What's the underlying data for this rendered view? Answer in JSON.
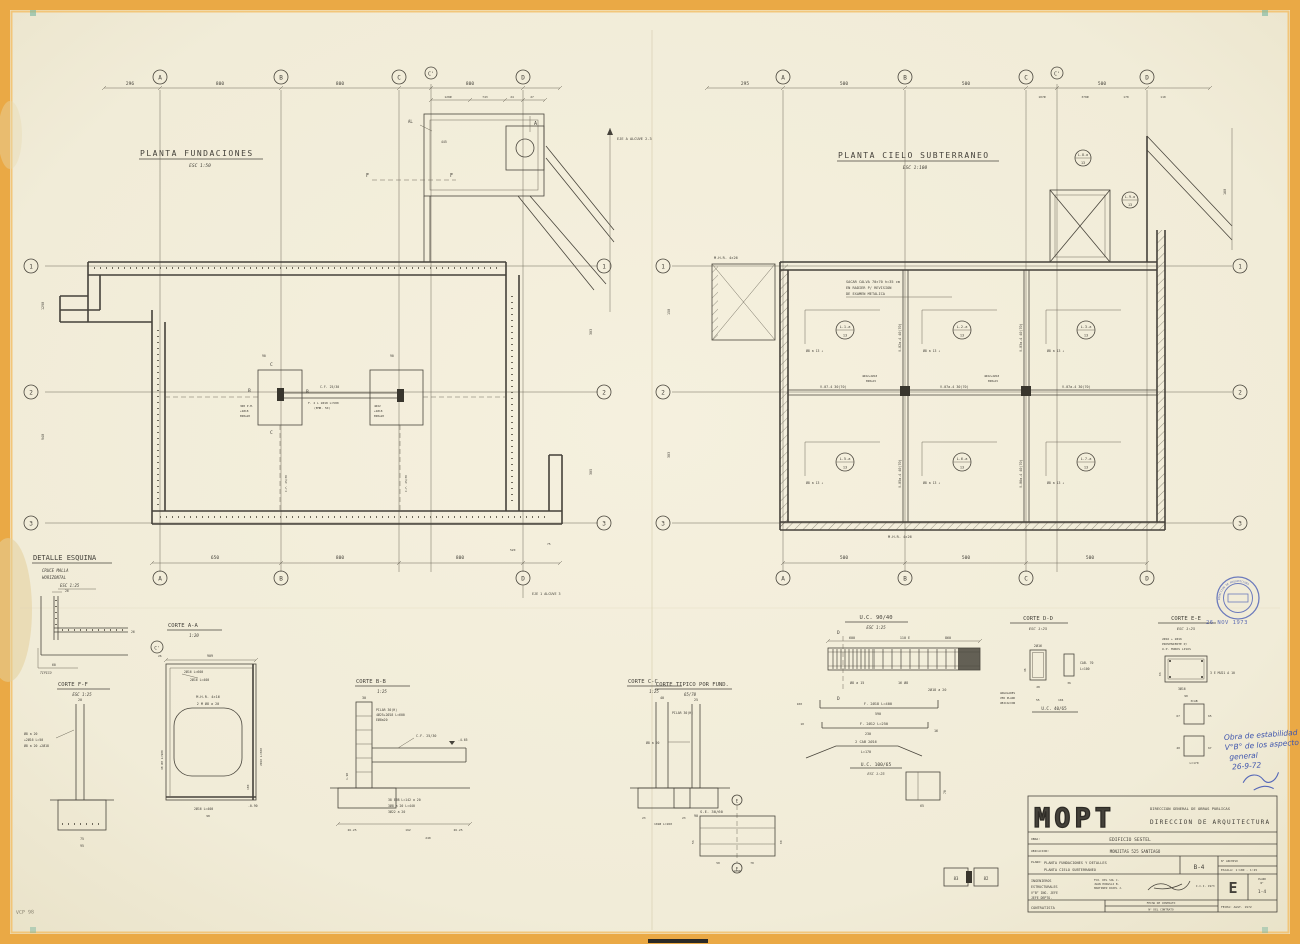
{
  "sheet": {
    "paper_color": "#f1ecd8",
    "border_color": "#e9a843",
    "ink_color": "#45423a",
    "stamp_blue": "#4456ac",
    "corner_code": "VCP 98"
  },
  "fp": {
    "title": "PLANTA FUNDACIONES",
    "scale": "ESC 1:50",
    "cols": [
      "A",
      "B",
      "C",
      "C'",
      "D"
    ],
    "rows": [
      "1",
      "2",
      "3"
    ],
    "top_dims": [
      "296",
      "800",
      "800",
      "800"
    ],
    "sub_dims": [
      "120Ø",
      "743",
      "24",
      "27"
    ],
    "bottom_dims": [
      "650",
      "800",
      "800"
    ],
    "left_dim_a": "1290",
    "left_dim_b": "940",
    "right_dim_a": "303",
    "right_dim_b": "305",
    "al": "AL",
    "a_mark": "A",
    "f_mark": "F",
    "dim_445": "445",
    "eje_top": "EJE A ALCUVE 2-3",
    "eje_bottom": "EJE 1 ALCUVE 3",
    "dim_520": "520",
    "dim_75": "75",
    "cf_tie": "C.F. 25/30",
    "tie_bar": "F. 2 L 2Ø18  L=580",
    "tie_emb": "(EMB. 50)",
    "b_mark": "B",
    "c_mark": "C",
    "dim_90": "90",
    "ped_left": [
      "3Ø8 P.M.",
      "+2Ø18",
      "EØ8a20"
    ],
    "ped_right": [
      "4Ø22",
      "+2Ø18",
      "EØ8a20"
    ],
    "cf_vert_left": "C.F. 25/30",
    "cf_vert_right": "C.F. 25/30"
  },
  "cp": {
    "title": "PLANTA CIELO SUBTERRANEO",
    "scale": "ESC 1:100",
    "cols": [
      "A",
      "B",
      "C",
      "C'",
      "D"
    ],
    "rows": [
      "1",
      "2",
      "3"
    ],
    "top_dims": [
      "295",
      "500",
      "500",
      "500"
    ],
    "sub_dims": [
      "107Ø",
      "370Ø",
      "170",
      "110"
    ],
    "bottom_dims": [
      "500",
      "500",
      "500"
    ],
    "left_dim_a": "150",
    "left_dim_b": "303",
    "right_dim_a": "160",
    "note": [
      "SACAR CALVA 70×70  h=35 cm",
      "EN RADIER P/ REVISION",
      "DE EXAMEN METALICA"
    ],
    "mhr_top": "M.H.R. 4×26",
    "mhr_bottom": "M.H.R. 4×26",
    "slabs": [
      {
        "mark": "L.1-a",
        "num": "13",
        "rebar": "Ø8 a 13 ↓"
      },
      {
        "mark": "L.2-a",
        "num": "13",
        "rebar": "Ø8 a 13 ↓"
      },
      {
        "mark": "L.3-a",
        "num": "13",
        "rebar": "Ø8 a 13 ↓"
      },
      {
        "mark": "L.5-a",
        "num": "13",
        "rebar": "Ø8 a 13 ↓"
      },
      {
        "mark": "L.6-a",
        "num": "13",
        "rebar": "Ø8 a 13 ↓"
      },
      {
        "mark": "L.7-a",
        "num": "13",
        "rebar": "Ø8 a 13 ↓"
      }
    ],
    "corner_slab_a": {
      "mark": "L.8-a",
      "num": "13"
    },
    "corner_slab_b": {
      "mark": "L.9-a",
      "num": "13"
    },
    "vbeams": [
      "V.02a-4 40(70)",
      "V.03a-4 40(70)",
      "V.05a-4 40(70)",
      "V.06a-4 40(70)"
    ],
    "hbeams": [
      "V.07-4  30(70)",
      "V.07a-4  30(70)",
      "V.07a-4  30(70)"
    ],
    "joint": [
      "4Ø22+2Ø18",
      "EØ8a15"
    ]
  },
  "det": {
    "corner": {
      "title": "DETALLE ESQUINA",
      "sub1": "CRUCE MALLA",
      "sub2": "HORIZONTAL",
      "scale": "ESC 1:25",
      "dim_26a": "26",
      "dim_26b": "26",
      "dim_60": "60",
      "typ": "TIPICO"
    },
    "ff": {
      "title": "CORTE F-F",
      "scale": "ESC 1:25",
      "lbl1": "Ø8 a 20",
      "lbl2": "+2Ø16  L=50",
      "lbl3": "Ø8 a 20 +2Ø18",
      "dim_20": "20",
      "dim_75": "75",
      "dim_95": "95"
    },
    "aa": {
      "title": "CORTE A-A",
      "scale": "1:20",
      "cprime": "C'",
      "dim_909": "909",
      "dim_26": "26",
      "lbl_600": "2Ø16 L=600",
      "lbl_400": "2Ø16 L=400",
      "mhr": "M.H.R. 4×16",
      "malla": "2 M Ø8 a 20",
      "lbl_48": "48 Ø8 L=900",
      "lbl_600r": "2Ø16 L=600",
      "dim_180": "180",
      "lbl_400b": "2Ø16 L=400",
      "dim_98": "98",
      "level": "-0.90"
    },
    "bb": {
      "title": "CORTE B-B",
      "scale": "1:25",
      "dim_top": "30",
      "pilar": [
        "PILAR 30(H)",
        "4Ø25+2Ø18 L=600",
        "EØ8a20"
      ],
      "cf": "C.F. 25/30",
      "level": "-4.65",
      "est1": "38 EØ8 L=142 a 20",
      "est2": "3Ø8 a 20  L=440",
      "est3": "3Ø22 a 20",
      "dim_190": "1.90",
      "dims": [
        "26.25",
        "162",
        "26.25"
      ],
      "dim_240": "240"
    },
    "cc": {
      "title": "CORTE C-C",
      "scale": "1:25",
      "dim_top": "40",
      "pilar": "PILAR 30(H)",
      "dims": [
        "23",
        "102Ø  L=260",
        "23"
      ]
    },
    "ct": {
      "title": "CORTE TIPICO POR FUND.",
      "scale": "65/70",
      "dim_top": "25",
      "lbl": "Ø8 a 20",
      "dim_bot": "90"
    },
    "se": {
      "title": "S.E. 30/60",
      "e_mark": "E",
      "dim_53": "53",
      "dim_60": "60",
      "dim_50": "50",
      "dim_70": "70",
      "dim_1040": "1040",
      "blk_a": "83",
      "blk_b": "82"
    },
    "uc90": {
      "title": "U.C. 90/40",
      "scale": "ESC 1:25",
      "d_mark": "D",
      "dims": [
        "600",
        "110 E",
        "860"
      ],
      "lbl1": "Ø8 a 15",
      "lbl2": "16 Ø8",
      "lbl3": "2Ø18 a 20"
    },
    "sched": {
      "bar1": "F. 2Ø18  L=400",
      "bar1_len": "590",
      "bar2": "F. 2Ø12  L=250",
      "bar2_len": "230",
      "bar2_hook": "16",
      "bar3": "2 CAB 2Ø16",
      "bar3_len": "L=170",
      "dim_100": "100",
      "dim_10": "10"
    },
    "uc100": {
      "title": "U.C. 100/65",
      "scale": "ESC 1:25",
      "dim_65": "65",
      "dim_70": "70"
    },
    "dd": {
      "title": "CORTE D-D",
      "scale": "ESC 1:25",
      "lbl_2016": "2Ø16",
      "dim_28": "28",
      "dim_46": "46",
      "dim_36": "36",
      "caja": "CAB. 70",
      "caja_len": "L=100",
      "ang": [
        "ANGULARES",
        "VER PLANO",
        "UBICACION"
      ],
      "uc": "U.C. 40/65",
      "dim_55": "55",
      "dim_104": "104"
    },
    "ee": {
      "title": "CORTE E-E",
      "scale": "ESC 1:25",
      "note": [
        "2Ø16 + 2Ø16",
        "PROVENIENTE P/",
        "U.P. MUROS LISOS"
      ],
      "lbl_est": "3 E MU21 A 10",
      "lbl_bar": "3Ø16",
      "dim_63": "63",
      "dim_90": "90"
    },
    "sq": {
      "lbl": "3CAB",
      "lbl_len": "L=170",
      "dim_65": "65",
      "dim_67a": "67",
      "dim_40": "40",
      "dim_67b": "67"
    }
  },
  "stamps": {
    "date": "26 NOV 1973",
    "round": "DIRECCION DE ARQUITECTURA",
    "hand": [
      "Obra de estabilidad",
      "V°B° de los aspecto",
      "general",
      "26-9-72"
    ]
  },
  "tb": {
    "logo": "MOPT",
    "org1": "DIRECCION GENERAL DE OBRAS PUBLICAS",
    "org2": "DIRECCION  DE  ARQUITECTURA",
    "obra_label": "OBRA:",
    "obra": "EDIFICIO   SESTEL",
    "ubi_label": "UBICACION:",
    "ubi": "MONJITAS    525    SANTIAGO",
    "plano_label": "PLANO:",
    "plano1": "PLANTA  FUNDACIONES  Y  DETALLES",
    "plano2": "PLANTA  CIELO  SUBTERRANEO",
    "code": "B-4",
    "archivo": "N° ARCHIVO",
    "escala": "ESCALA: 1:100 - 1:25",
    "ing1": "INGENIEROS",
    "ing2": "ESTRUCTURALES",
    "names": [
      "FCO. DEL SOL C.",
      "JUAN HODGSLI B.",
      "MARTINEZ ROJEL J."
    ],
    "date_note": "I.C.I. 1973",
    "vb": "V°B°  ING. JEFE",
    "jefe": "JEFE  DEPTO.",
    "contratista": "CONTRATISTA",
    "fecha_contrato": "FECHA DE CONTRATO",
    "num_contrato": "N° DEL CONTRATO",
    "plano_n1": "PLANO",
    "plano_n2": "N°",
    "letter": "E",
    "num": "1-4",
    "fecha": "FECHA:  AGST. 1972"
  }
}
